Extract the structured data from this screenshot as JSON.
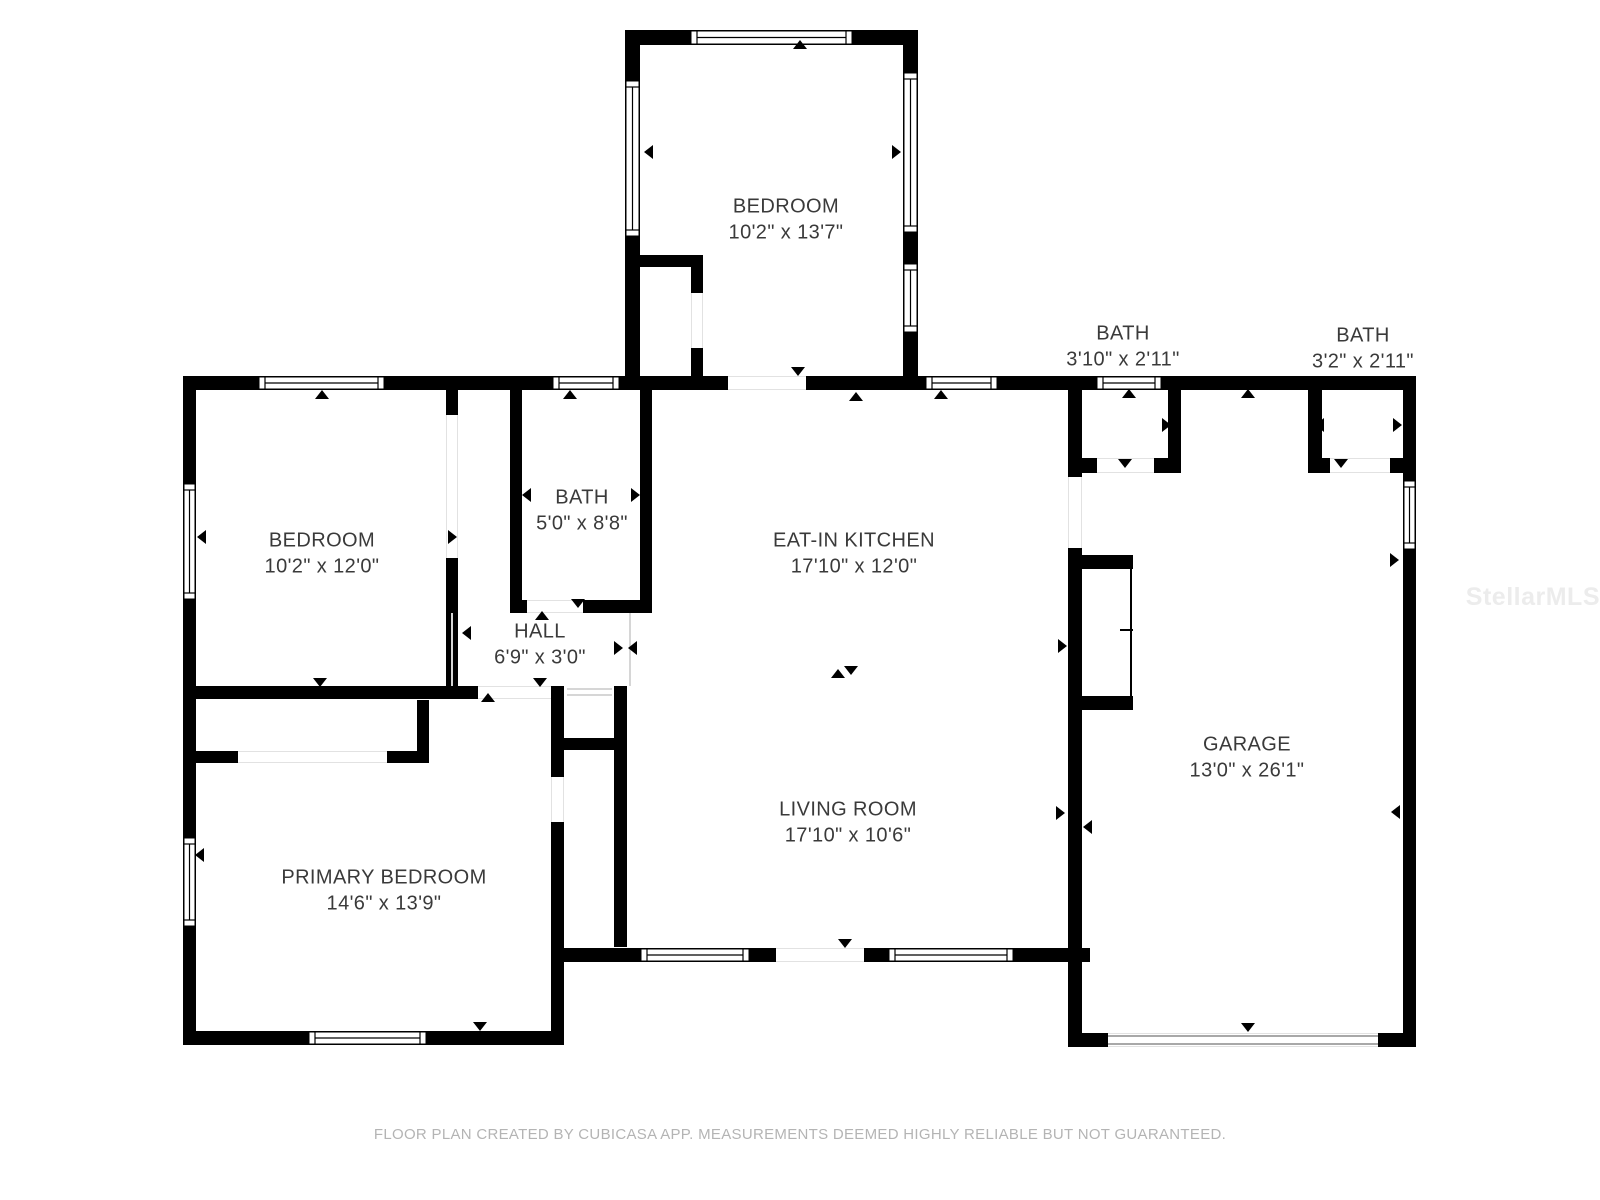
{
  "colors": {
    "background": "#ffffff",
    "wall": "#000000",
    "window_fill": "#ffffff",
    "window_stroke": "#000000",
    "door_edge_line": "#e2e2e2",
    "divider_line": "#d6d6d6",
    "garage_door_line": "#8c8c8c",
    "label_text": "#3a3a3a",
    "footer_text": "#b4b4b4",
    "watermark_text": "#ececec"
  },
  "footer": {
    "text": "FLOOR PLAN CREATED BY CUBICASA APP. MEASUREMENTS DEEMED HIGHLY RELIABLE BUT NOT GUARANTEED."
  },
  "watermark": {
    "text": "StellarMLS"
  },
  "plan": {
    "width": 1600,
    "height": 1200,
    "dims_line_offset": 26,
    "rooms": [
      {
        "id": "bedroom-top",
        "name": "BEDROOM",
        "dims": "10'2\" x 13'7\"",
        "x": 786,
        "y": 207
      },
      {
        "id": "bath-hall-1",
        "name": "BATH",
        "dims": "3'10\" x 2'11\"",
        "x": 1123,
        "y": 334
      },
      {
        "id": "bath-hall-2",
        "name": "BATH",
        "dims": "3'2\" x 2'11\"",
        "x": 1363,
        "y": 336
      },
      {
        "id": "bedroom-left",
        "name": "BEDROOM",
        "dims": "10'2\" x 12'0\"",
        "x": 322,
        "y": 541
      },
      {
        "id": "bath-main",
        "name": "BATH",
        "dims": "5'0\" x 8'8\"",
        "x": 582,
        "y": 498
      },
      {
        "id": "eat-in-kitchen",
        "name": "EAT-IN KITCHEN",
        "dims": "17'10\" x 12'0\"",
        "x": 854,
        "y": 541
      },
      {
        "id": "hall",
        "name": "HALL",
        "dims": "6'9\" x 3'0\"",
        "x": 540,
        "y": 632
      },
      {
        "id": "garage",
        "name": "GARAGE",
        "dims": "13'0\" x 26'1\"",
        "x": 1247,
        "y": 745
      },
      {
        "id": "living-room",
        "name": "LIVING ROOM",
        "dims": "17'10\" x 10'6\"",
        "x": 848,
        "y": 810
      },
      {
        "id": "primary-bedroom",
        "name": "PRIMARY BEDROOM",
        "dims": "14'6\" x 13'9\"",
        "x": 384,
        "y": 878
      }
    ],
    "walls": [
      [
        625,
        30,
        15,
        346
      ],
      [
        625,
        30,
        293,
        15
      ],
      [
        903,
        30,
        15,
        346
      ],
      [
        640,
        255,
        63,
        12
      ],
      [
        691,
        255,
        12,
        38
      ],
      [
        691,
        348,
        12,
        40
      ],
      [
        183,
        376,
        75,
        14
      ],
      [
        385,
        376,
        167,
        14
      ],
      [
        620,
        376,
        108,
        14
      ],
      [
        806,
        376,
        119,
        14
      ],
      [
        998,
        376,
        98,
        14
      ],
      [
        1162,
        376,
        254,
        14
      ],
      [
        183,
        390,
        13,
        93
      ],
      [
        183,
        600,
        13,
        237
      ],
      [
        183,
        927,
        13,
        118
      ],
      [
        446,
        390,
        12,
        25
      ],
      [
        446,
        558,
        12,
        140
      ],
      [
        510,
        390,
        12,
        210
      ],
      [
        510,
        600,
        17,
        13
      ],
      [
        583,
        600,
        69,
        13
      ],
      [
        640,
        390,
        12,
        221
      ],
      [
        196,
        686,
        282,
        13
      ],
      [
        417,
        700,
        12,
        63
      ],
      [
        196,
        751,
        42,
        12
      ],
      [
        387,
        751,
        42,
        12
      ],
      [
        551,
        686,
        13,
        91
      ],
      [
        551,
        822,
        13,
        223
      ],
      [
        614,
        686,
        13,
        261
      ],
      [
        564,
        738,
        50,
        12
      ],
      [
        552,
        948,
        88,
        14
      ],
      [
        750,
        948,
        26,
        14
      ],
      [
        864,
        948,
        24,
        14
      ],
      [
        1014,
        948,
        76,
        14
      ],
      [
        183,
        1031,
        125,
        14
      ],
      [
        427,
        1031,
        137,
        14
      ],
      [
        1068,
        390,
        14,
        87
      ],
      [
        1068,
        548,
        14,
        499
      ],
      [
        1168,
        390,
        13,
        83
      ],
      [
        1068,
        458,
        29,
        15
      ],
      [
        1154,
        458,
        27,
        15
      ],
      [
        1308,
        390,
        14,
        83
      ],
      [
        1308,
        458,
        22,
        15
      ],
      [
        1390,
        458,
        26,
        15
      ],
      [
        1403,
        390,
        13,
        90
      ],
      [
        1403,
        550,
        13,
        497
      ],
      [
        1068,
        1033,
        40,
        14
      ],
      [
        1378,
        1033,
        38,
        14
      ],
      [
        1082,
        555,
        51,
        14
      ],
      [
        1082,
        696,
        51,
        14
      ]
    ],
    "windows": [
      [
        258,
        376,
        127,
        14,
        "h"
      ],
      [
        552,
        376,
        68,
        14,
        "h"
      ],
      [
        925,
        376,
        73,
        14,
        "h"
      ],
      [
        1096,
        376,
        66,
        14,
        "h"
      ],
      [
        690,
        30,
        163,
        15,
        "h"
      ],
      [
        625,
        80,
        15,
        157,
        "v"
      ],
      [
        903,
        72,
        15,
        161,
        "v"
      ],
      [
        903,
        263,
        15,
        70,
        "v"
      ],
      [
        183,
        483,
        13,
        117,
        "v"
      ],
      [
        183,
        837,
        13,
        90,
        "v"
      ],
      [
        640,
        948,
        110,
        14,
        "h"
      ],
      [
        888,
        948,
        126,
        14,
        "h"
      ],
      [
        308,
        1031,
        119,
        14,
        "h"
      ],
      [
        1403,
        480,
        13,
        70,
        "v"
      ]
    ],
    "doors": [
      [
        728,
        376,
        78,
        14
      ],
      [
        446,
        415,
        12,
        143
      ],
      [
        527,
        600,
        56,
        13
      ],
      [
        478,
        686,
        73,
        13
      ],
      [
        776,
        948,
        88,
        14
      ],
      [
        1097,
        458,
        57,
        15
      ],
      [
        1330,
        458,
        60,
        15
      ],
      [
        1068,
        477,
        14,
        71
      ],
      [
        1108,
        1033,
        270,
        14
      ],
      [
        691,
        293,
        12,
        55
      ],
      [
        238,
        751,
        149,
        12
      ],
      [
        551,
        777,
        13,
        45
      ]
    ],
    "divider_lines": [
      [
        452,
        613,
        452,
        686
      ],
      [
        567,
        689,
        612,
        689
      ],
      [
        567,
        695,
        612,
        695
      ],
      [
        630,
        613,
        630,
        686
      ]
    ],
    "garage_door_lines": [
      [
        1108,
        1036,
        1378,
        1036
      ],
      [
        1108,
        1044,
        1378,
        1044
      ]
    ],
    "fixture_lines": [
      [
        1131,
        562,
        1131,
        701
      ],
      [
        1120,
        630,
        1133,
        630
      ]
    ],
    "arrows": [
      [
        800,
        45,
        "up"
      ],
      [
        649,
        152,
        "left"
      ],
      [
        896,
        152,
        "right"
      ],
      [
        798,
        371,
        "down"
      ],
      [
        856,
        397,
        "up"
      ],
      [
        322,
        395,
        "up"
      ],
      [
        570,
        395,
        "up"
      ],
      [
        941,
        395,
        "up"
      ],
      [
        1129,
        394,
        "up"
      ],
      [
        1248,
        394,
        "up"
      ],
      [
        202,
        537,
        "left"
      ],
      [
        452,
        537,
        "right"
      ],
      [
        320,
        682,
        "down"
      ],
      [
        527,
        495,
        "left"
      ],
      [
        635,
        495,
        "right"
      ],
      [
        578,
        603,
        "down"
      ],
      [
        542,
        616,
        "up"
      ],
      [
        540,
        682,
        "down"
      ],
      [
        488,
        698,
        "up"
      ],
      [
        467,
        633,
        "left"
      ],
      [
        618,
        648,
        "right"
      ],
      [
        633,
        648,
        "left"
      ],
      [
        838,
        674,
        "up"
      ],
      [
        851,
        670,
        "down"
      ],
      [
        1073,
        425,
        "left"
      ],
      [
        1166,
        425,
        "right"
      ],
      [
        1125,
        463,
        "down"
      ],
      [
        1320,
        425,
        "left"
      ],
      [
        1397,
        425,
        "right"
      ],
      [
        1341,
        463,
        "down"
      ],
      [
        1062,
        646,
        "right"
      ],
      [
        1060,
        813,
        "right"
      ],
      [
        1088,
        827,
        "left"
      ],
      [
        845,
        943,
        "down"
      ],
      [
        200,
        855,
        "left"
      ],
      [
        480,
        1026,
        "down"
      ],
      [
        1248,
        1027,
        "down"
      ],
      [
        1394,
        560,
        "right"
      ],
      [
        1396,
        812,
        "left"
      ]
    ]
  }
}
